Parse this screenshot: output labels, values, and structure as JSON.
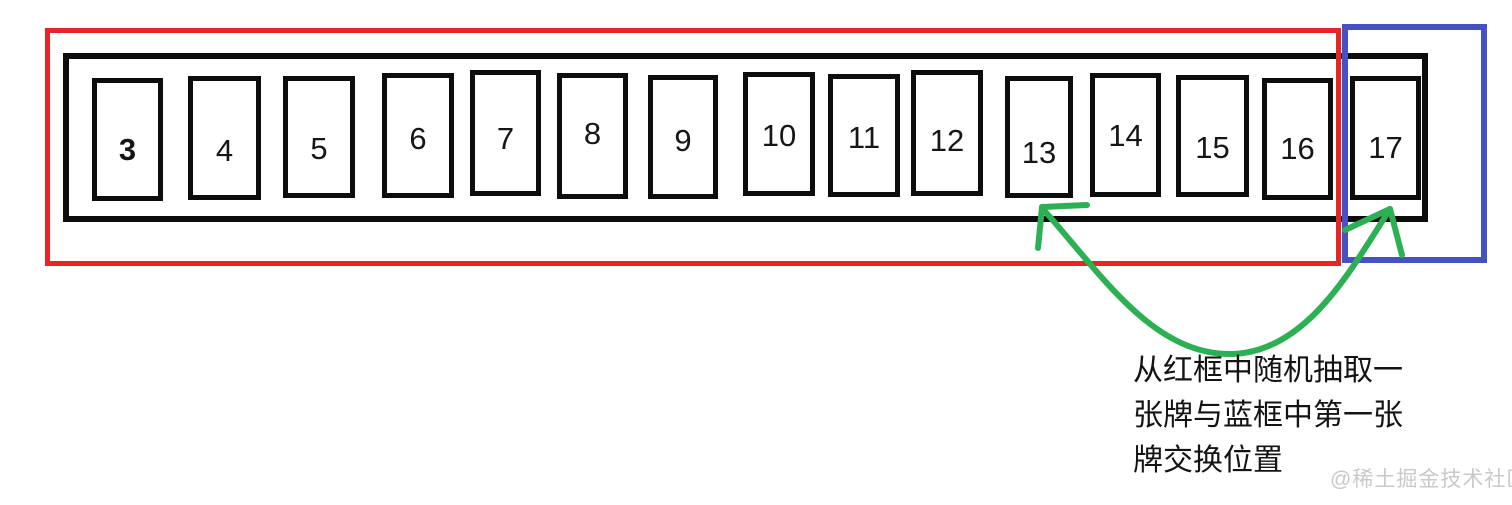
{
  "diagram": {
    "description_role": "card swap illustration",
    "cards": [
      {
        "value": "3",
        "bold": true
      },
      {
        "value": "4"
      },
      {
        "value": "5"
      },
      {
        "value": "6"
      },
      {
        "value": "7"
      },
      {
        "value": "8"
      },
      {
        "value": "9"
      },
      {
        "value": "10"
      },
      {
        "value": "11"
      },
      {
        "value": "12"
      },
      {
        "value": "13"
      },
      {
        "value": "14"
      },
      {
        "value": "15"
      },
      {
        "value": "16"
      },
      {
        "value": "17"
      }
    ],
    "annotation": {
      "lines": [
        "从红框中随机抽取一",
        "张牌与蓝框中第一张",
        "牌交换位置"
      ]
    },
    "watermark": "@稀土掘金技术社区",
    "colors": {
      "red_frame": "#e8232a",
      "blue_frame": "#4652c4",
      "arrow_green": "#2cb053",
      "outline_black": "#0d0d0d",
      "watermark_gray": "#c9c9c9"
    }
  }
}
